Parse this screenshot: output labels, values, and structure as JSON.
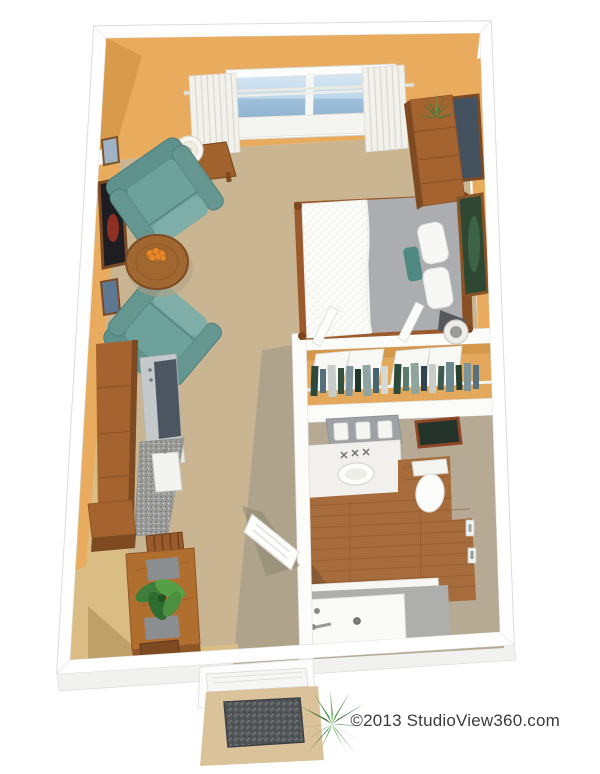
{
  "watermark": {
    "text": "©2013 StudioView360.com"
  },
  "palette": {
    "white": "#FFFFFF",
    "wall": "#E9AC5E",
    "wallDark": "#D89A4B",
    "carpet": "#C9B592",
    "carpetShadow": "#AFA38B",
    "kitchenFloor": "#D9BD85",
    "kitchenFloorDark": "#BFA069",
    "closetWall": "#E4A85C",
    "taupe": "#B6AA94",
    "woodFloor": "#A66C3B",
    "woodFurniture": "#A4632F",
    "woodDark": "#7E4A22",
    "teal": "#6FA19C",
    "tealDark": "#5E918B",
    "blanket": "#ACADB0",
    "tubGray": "#AEAEAC",
    "sky": "#AFCBE2",
    "curtain": "#F2F1EC",
    "matTan": "#DAC29A",
    "doormat": "#54575A",
    "plantGreen": "#3E7D3A",
    "fruitOrange": "#E8882A"
  },
  "scene": {
    "style": "3d-isometric-studio-floorplan-render",
    "rooms": [
      "living-bedroom",
      "kitchen",
      "closet",
      "bathroom",
      "entry"
    ],
    "furniture": [
      "window",
      "curtains",
      "armchair-1",
      "armchair-2",
      "round-coffee-table",
      "fruit-bowl",
      "side-table",
      "table-lamp",
      "wall-art-small",
      "wall-art-large",
      "wall-art-lower",
      "bed",
      "pillows",
      "armoire",
      "armoire-plant",
      "tv-panel",
      "green-wall-art",
      "closet-rod-with-clothes",
      "bifold-doors",
      "vanity",
      "sink",
      "toilet",
      "bathtub",
      "towel-bars",
      "kitchen-cabinets",
      "range",
      "countertop-sink",
      "dining-table",
      "dining-chairs",
      "table-plant",
      "entry-door",
      "doormat",
      "entry-plant"
    ]
  }
}
